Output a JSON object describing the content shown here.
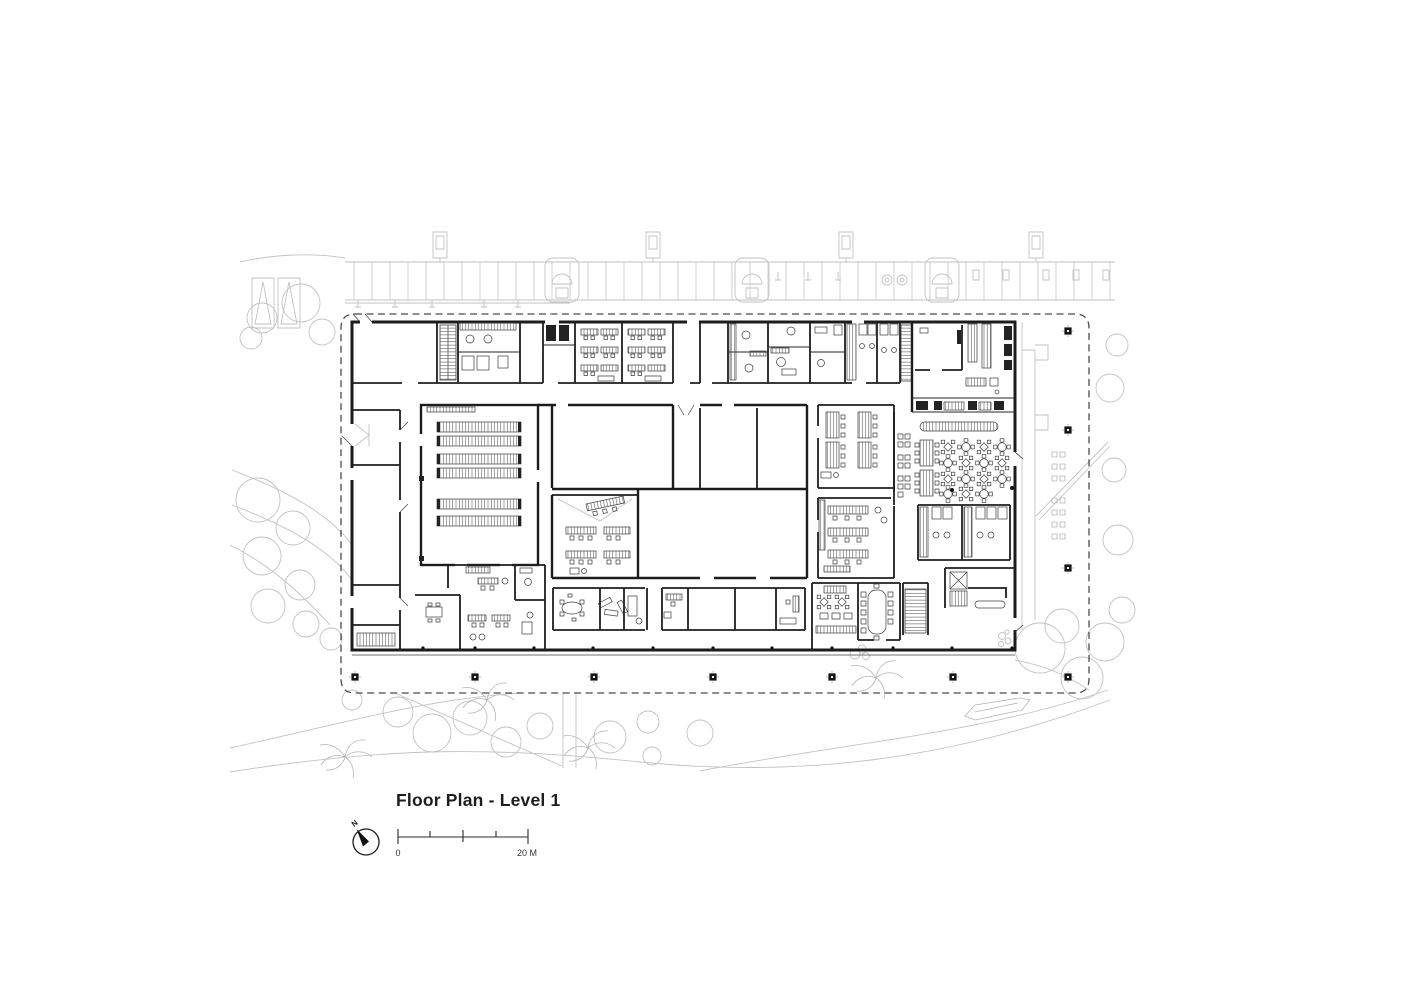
{
  "drawing": {
    "title": "Floor Plan - Level 1",
    "compass": {
      "label": "N"
    },
    "scale_bar": {
      "zero_label": "0",
      "max_label": "20 M"
    },
    "colors": {
      "ink": "#1c1c1c",
      "furniture": "#3c3c3c",
      "site_gray": "#c2c2c2",
      "boundary_gray": "#4a4a4a",
      "background": "#ffffff"
    }
  }
}
